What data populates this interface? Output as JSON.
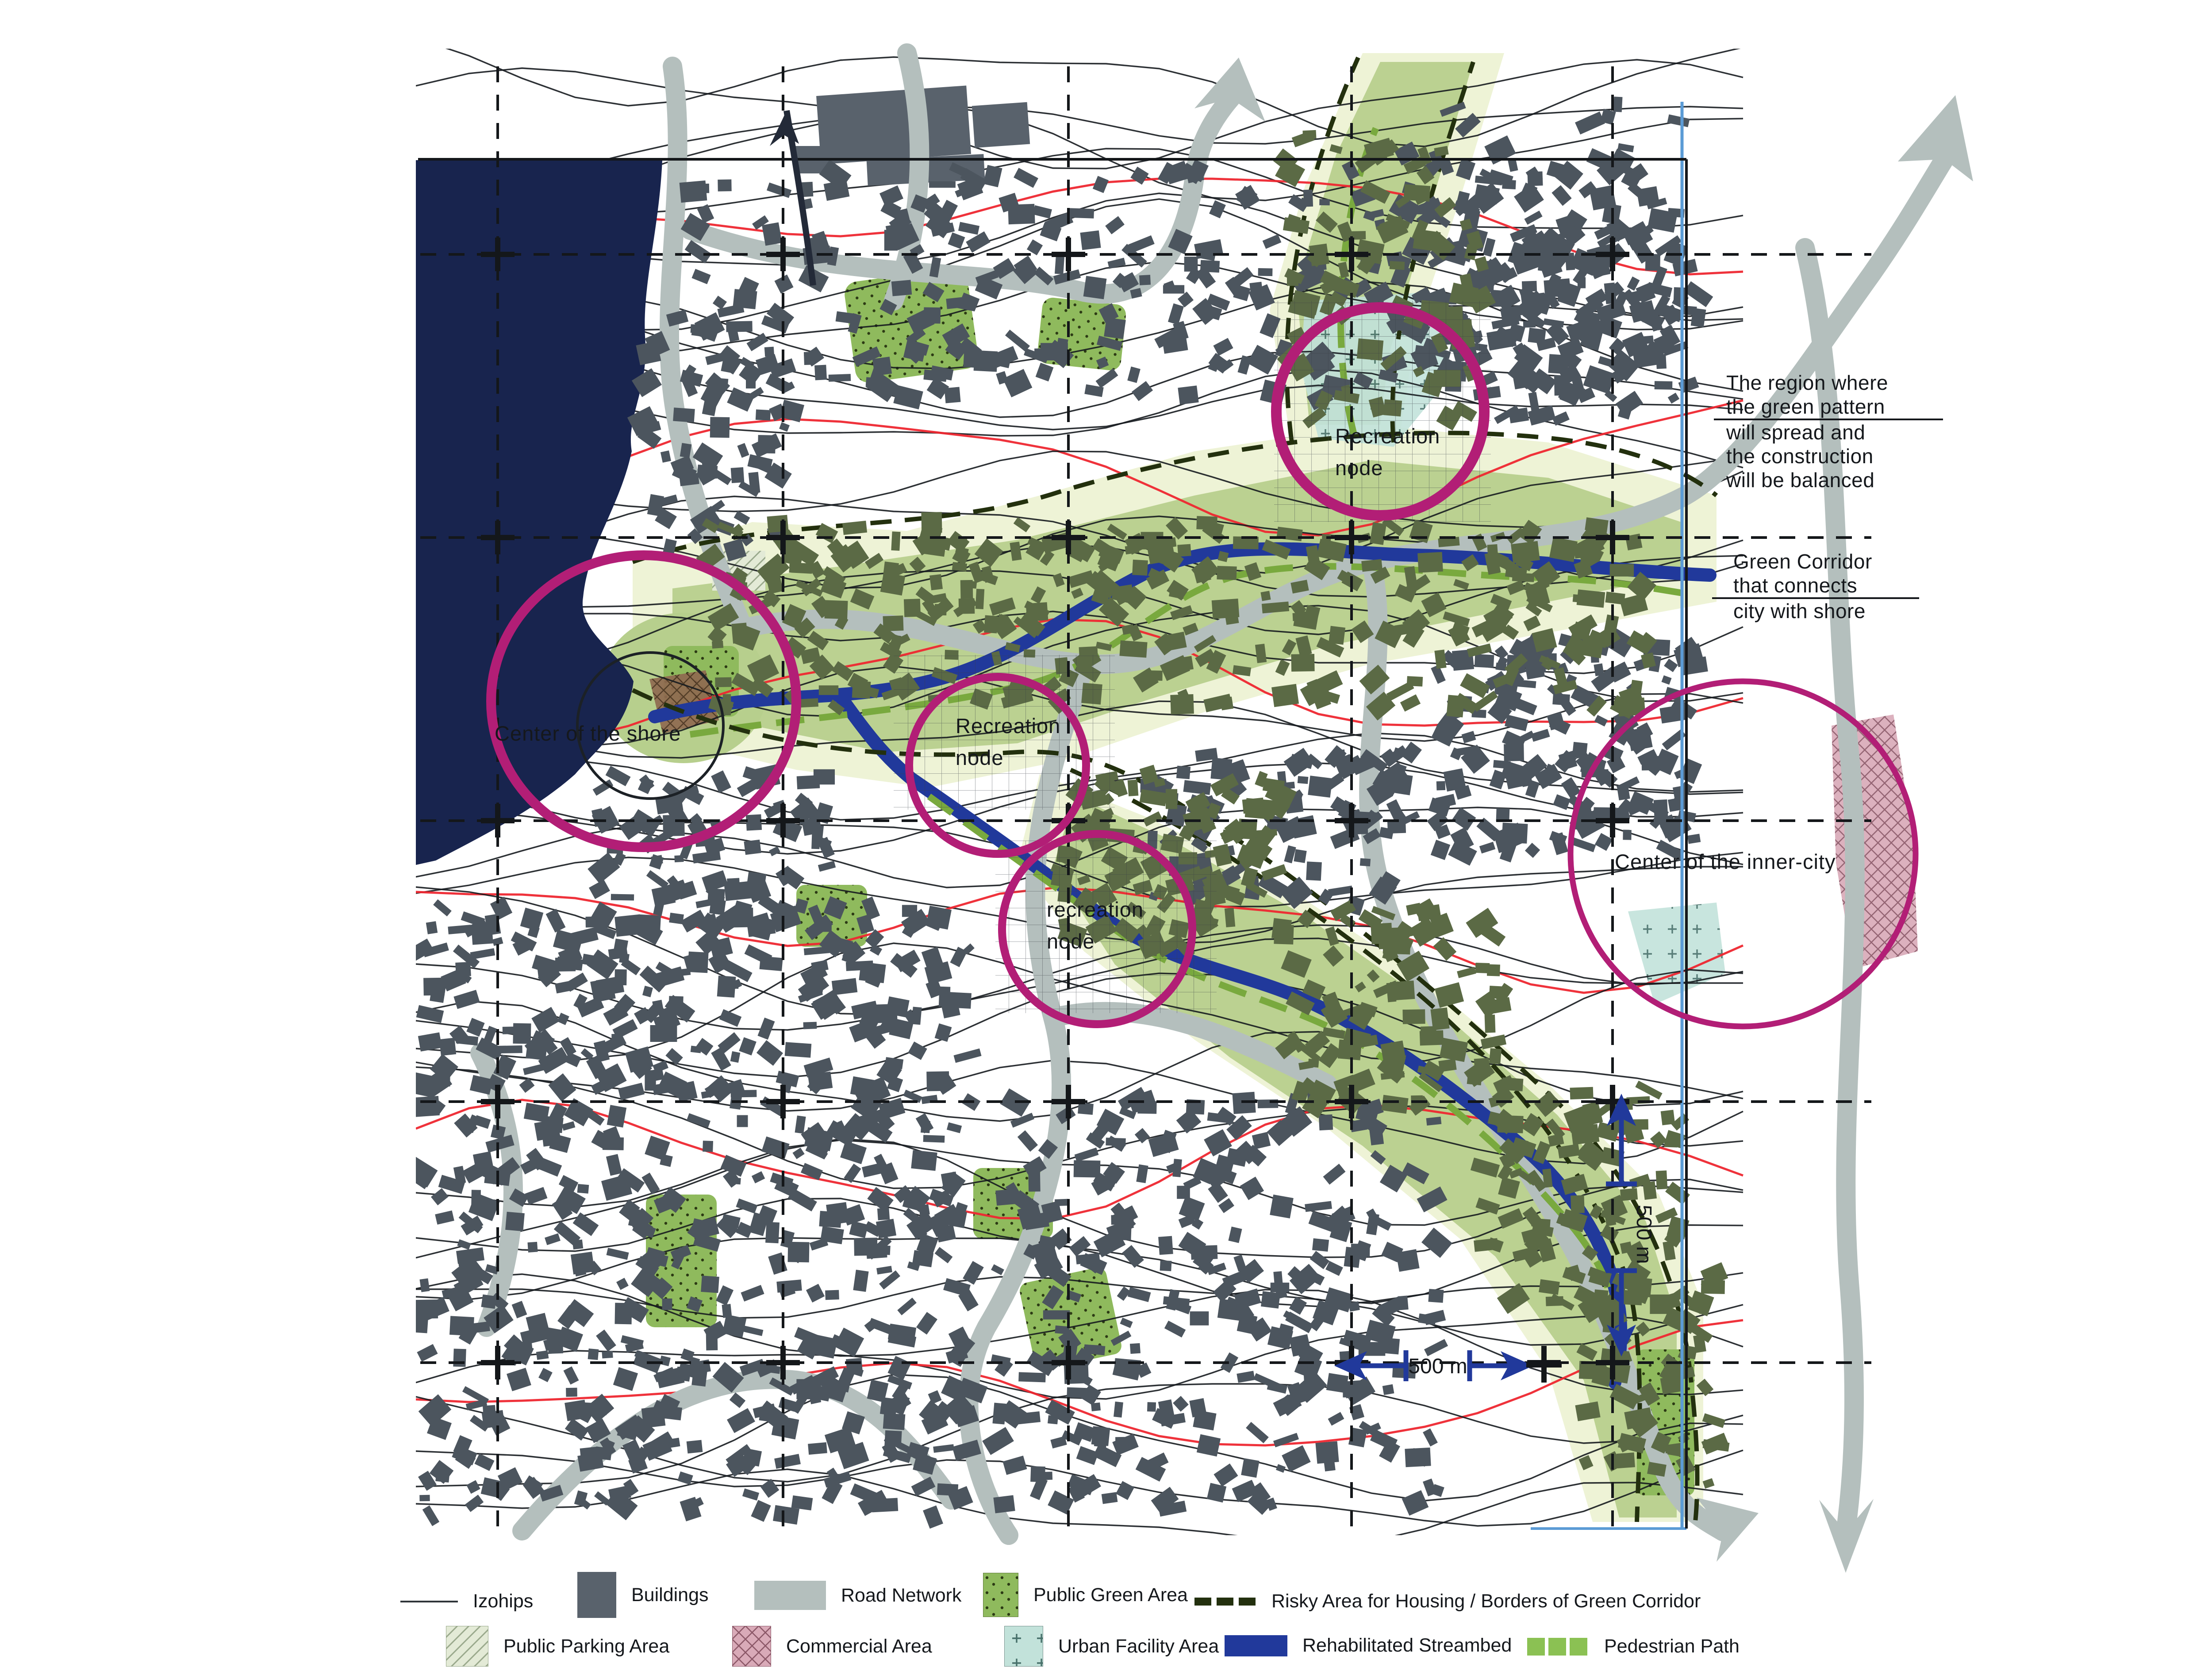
{
  "title": "Green corridor urban planning schema",
  "colors": {
    "sea": "#18244e",
    "road": "#b4bfbd",
    "stream": "#21399b",
    "pedestrian": "#79a93e",
    "pedestrian_light": "#8bc153",
    "corridor_light": "#eef3d6",
    "corridor_mid": "#b7cf8d",
    "green_dark": "#8fba5d",
    "building": "#4c555e",
    "building_olive": "#5b6a45",
    "harbor": "#59626c",
    "node_circle": "#b21e76",
    "risky_border": "#23300e",
    "contour": "#161b1f",
    "contour_red": "#ee2730",
    "grid_blue": "#5b9bd5",
    "urban_facility": "#c2e2da",
    "commercial_pink": "#d9aab8",
    "commercial_brown": "#8f6a50",
    "parking": "#e3ead6",
    "text": "#15181c"
  },
  "annotations": {
    "recreation_top_line1": "Recreation",
    "recreation_top_line2": "node",
    "recreation_mid_line1": "Recreation",
    "recreation_mid_line2": "node",
    "recreation_low_line1": "recreation",
    "recreation_low_line2": "node",
    "center_shore": "Center of the shore",
    "center_inner_city": "Center of the inner-city"
  },
  "notes": {
    "region_lines": [
      "The region where",
      "the green pattern",
      "will spread and",
      "the construction",
      "will be balanced"
    ],
    "corridor_lines": [
      "Green Corridor",
      "that connects",
      "city with shore"
    ]
  },
  "scale": {
    "vertical": "500 m",
    "horizontal": "500 m"
  },
  "legend": {
    "row1": [
      {
        "label": "Izohips",
        "swatch": "contour-line"
      },
      {
        "label": "Buildings",
        "swatch": "building-square"
      },
      {
        "label": "Road Network",
        "swatch": "road-bar"
      },
      {
        "label": "Public Green Area",
        "swatch": "green-dotted-square"
      },
      {
        "label": "Risky Area for Housing / Borders of Green Corridor",
        "swatch": "dark-green-dashes"
      }
    ],
    "row2": [
      {
        "label": "Public Parking Area",
        "swatch": "hatched-square"
      },
      {
        "label": "Commercial Area",
        "swatch": "pink-crosshatch-square"
      },
      {
        "label": "Urban Facility Area",
        "swatch": "blue-plus-square"
      },
      {
        "label": "Rehabilitated Streambed",
        "swatch": "blue-bar"
      },
      {
        "label": "Pedestrian Path",
        "swatch": "green-dashes"
      }
    ]
  }
}
